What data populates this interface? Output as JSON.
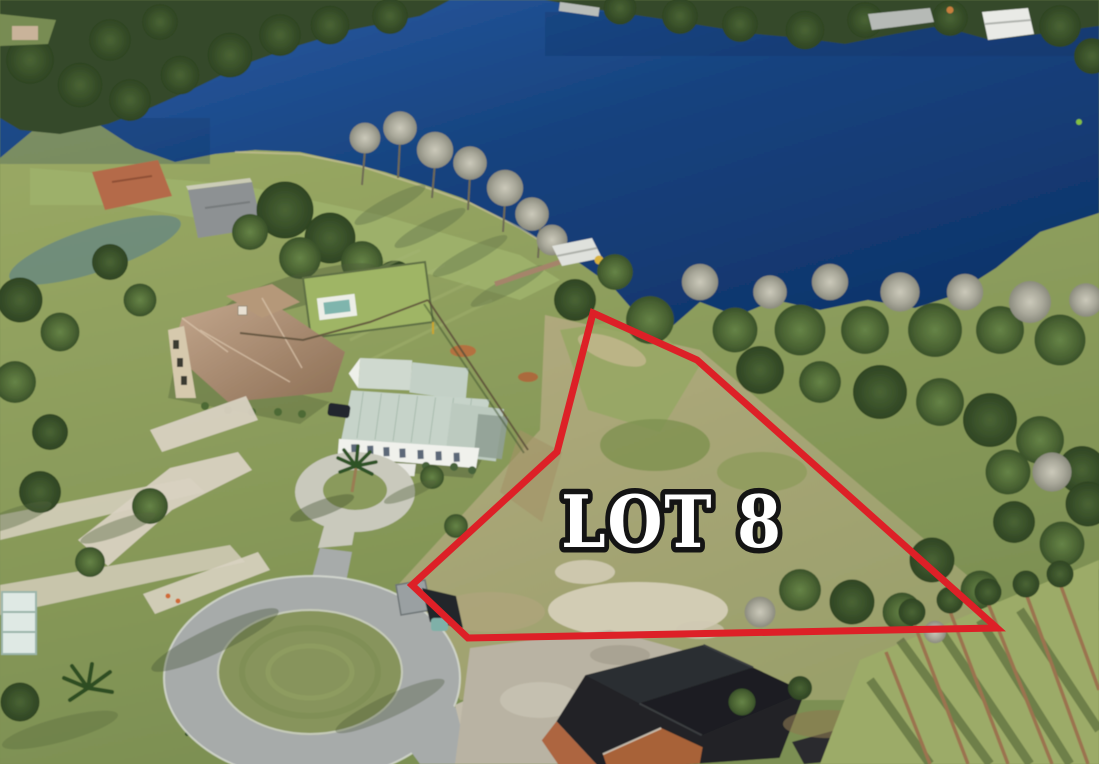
{
  "scene": {
    "kind": "aerial-drone-photograph",
    "subject": "Lakefront vacant residential lot on a cul-de-sac, outlined in red",
    "label": {
      "text": "LOT 8"
    },
    "lot_outline": {
      "points": "593,313 697,360 997,628 468,638 412,585 557,452",
      "color": "#dd2027",
      "stroke_width": 7
    },
    "colors": {
      "lake_deep": "#0e3166",
      "lake_mid": "#17437f",
      "lake_light": "#2b5ea6",
      "lawn_green": "#8ea25f",
      "lot_field_tan": "#a9a478",
      "forest_green": "#3f5330",
      "bare_tree_gray": "#a9a89a",
      "road_gray": "#a7abaa",
      "paver_light": "#d8d1c1",
      "tile_roof_brown": "#a98a6e",
      "metal_roof_seafoam": "#c6d3c9",
      "construction_roof_black": "#222427",
      "sand_patch": "#d7d0bb",
      "label_fill": "#ffffff",
      "label_outline": "#141414"
    }
  }
}
